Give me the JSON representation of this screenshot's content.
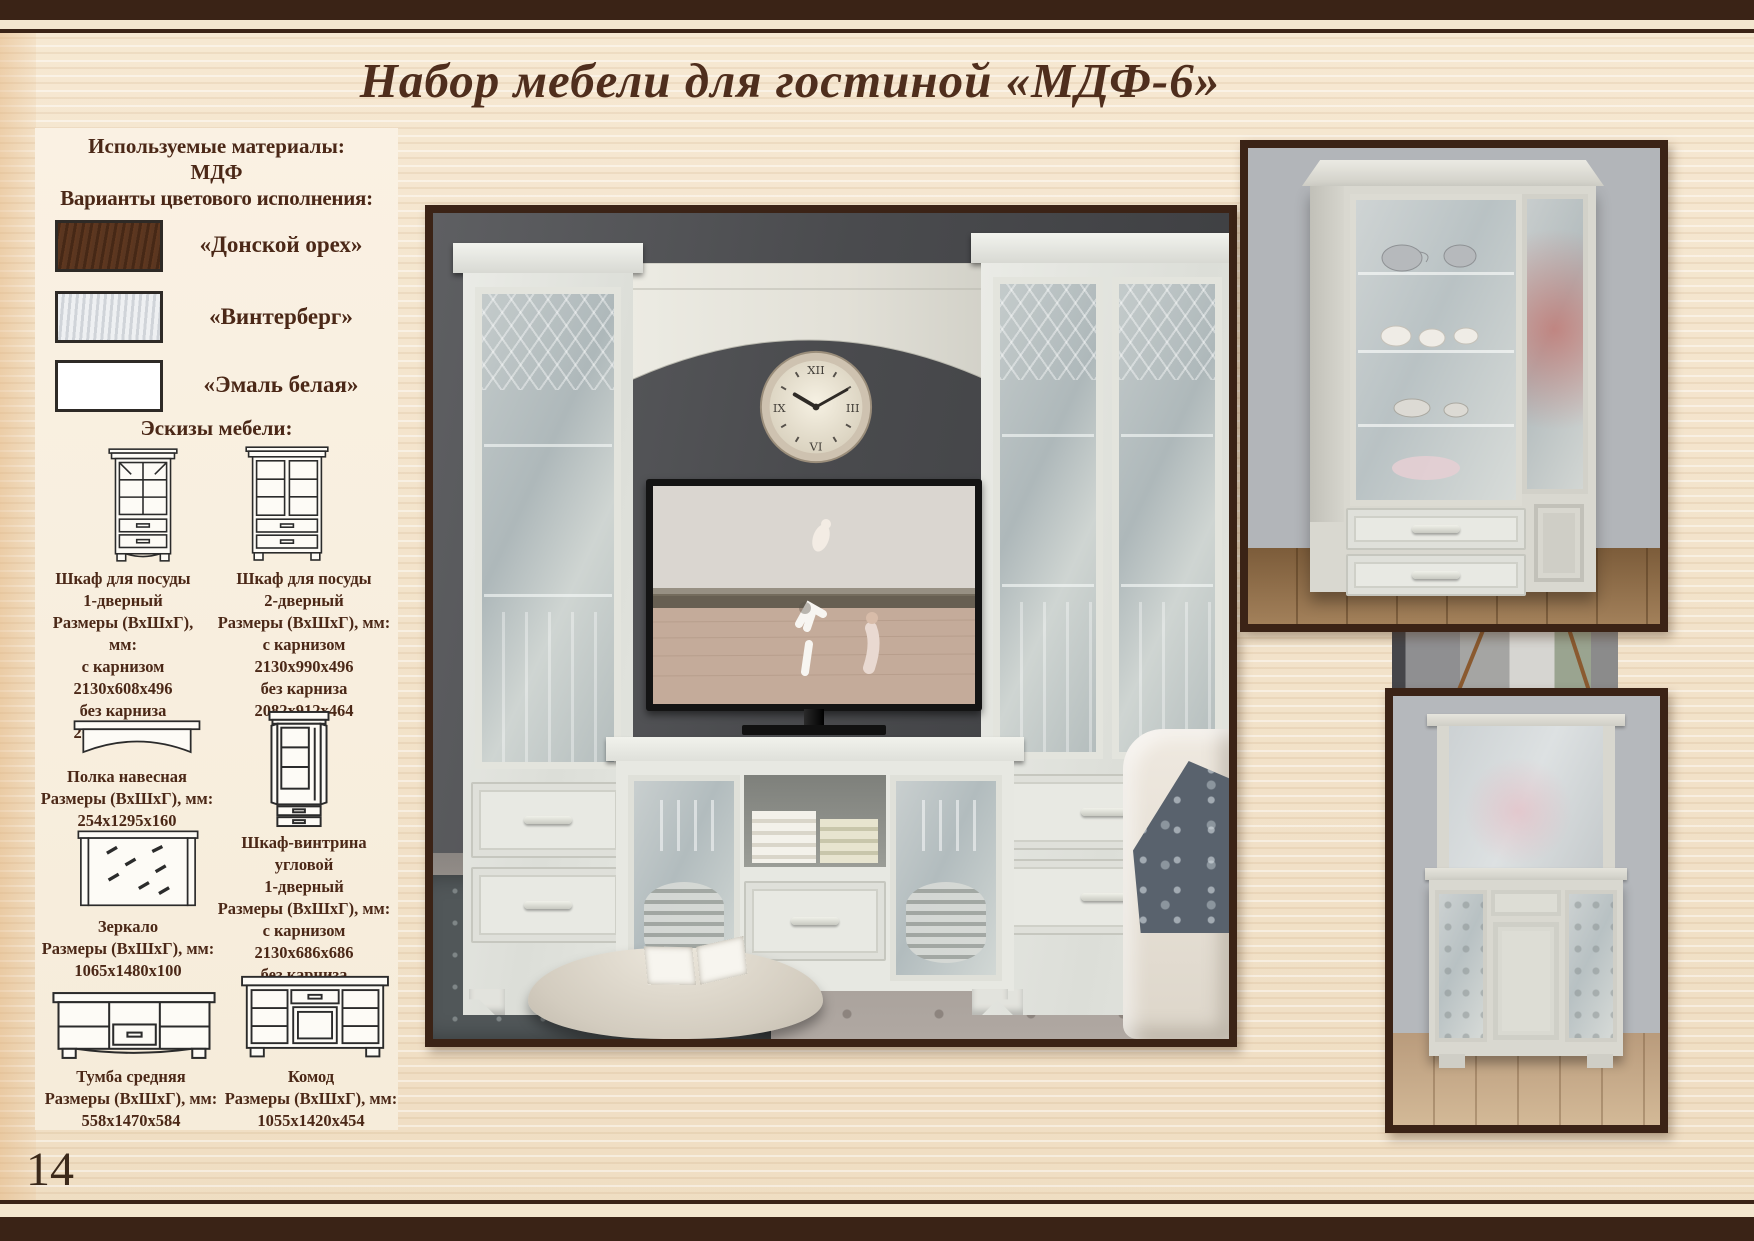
{
  "page": {
    "title": "Набор мебели для гостиной «МДФ-6»",
    "number": "14"
  },
  "theme": {
    "frame_color": "#3a2316",
    "text_color": "#4b2817",
    "wood_background": "#f2e2ca"
  },
  "sidebar": {
    "materials_heading": "Используемые материалы:",
    "material": "МДФ",
    "colors_heading": "Варианты цветового исполнения:",
    "colors": [
      {
        "label": "«Донской орех»",
        "hex": "#5a3620"
      },
      {
        "label": "«Винтерберг»",
        "hex": "#dde0e4"
      },
      {
        "label": "«Эмаль белая»",
        "hex": "#ffffff"
      }
    ],
    "sketches_heading": "Эскизы мебели:",
    "items": [
      {
        "name": "cupboard-1-door",
        "caption": "Шкаф для посуды\n1-дверный\nРазмеры (ВхШхГ), мм:\nс карнизом\n2130х608х496\nбез карниза\n2082х530х464"
      },
      {
        "name": "cupboard-2-door",
        "caption": "Шкаф для посуды\n2-дверный\nРазмеры (ВхШхГ), мм:\nс карнизом\n2130х990х496\nбез карниза\n2082х912х464"
      },
      {
        "name": "wall-shelf",
        "caption": "Полка навесная\nРазмеры (ВхШхГ), мм:\n254х1295х160"
      },
      {
        "name": "corner-vitrine",
        "caption": "Шкаф-винтрина угловой\n1-дверный\nРазмеры (ВхШхГ), мм:\nс карнизом\n2130х686х686\nбез карниза\n2082х647х647"
      },
      {
        "name": "mirror",
        "caption": "Зеркало\nРазмеры (ВхШхГ), мм:\n1065х1480х100"
      },
      {
        "name": "tv-stand",
        "caption": "Тумба средняя\nРазмеры (ВхШхГ), мм:\n558х1470х584"
      },
      {
        "name": "chest",
        "caption": "Комод\nРазмеры (ВхШхГ), мм:\n1055х1420х454"
      }
    ]
  }
}
